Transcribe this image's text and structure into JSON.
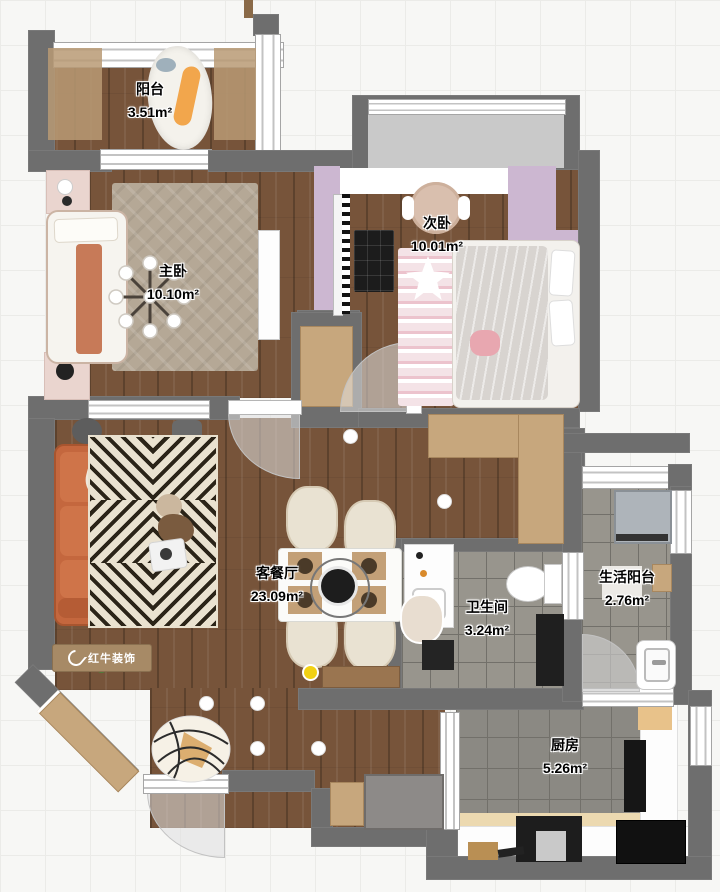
{
  "canvas": {
    "background": "#f7f7f5",
    "grid_color": "#ebebe8",
    "grid_size_px": 45
  },
  "brand": {
    "logo_text": "红牛装饰"
  },
  "rooms": [
    {
      "id": "balcony",
      "name": "阳台",
      "area": "3.51m²"
    },
    {
      "id": "master-bedroom",
      "name": "主卧",
      "area": "10.10m²"
    },
    {
      "id": "second-bedroom",
      "name": "次卧",
      "area": "10.01m²"
    },
    {
      "id": "living-dining-room",
      "name": "客餐厅",
      "area": "23.09m²"
    },
    {
      "id": "bathroom",
      "name": "卫生间",
      "area": "3.24m²"
    },
    {
      "id": "service-balcony",
      "name": "生活阳台",
      "area": "2.76m²"
    },
    {
      "id": "kitchen",
      "name": "厨房",
      "area": "5.26m²"
    }
  ],
  "palette": {
    "wall": "#6e6e6e",
    "wood_floor": "#77543a",
    "tile_floor": "#98958d",
    "accent_wall": "#ccb7d1",
    "sofa": "#c4673e",
    "highlight_dot": "#f2d113"
  }
}
